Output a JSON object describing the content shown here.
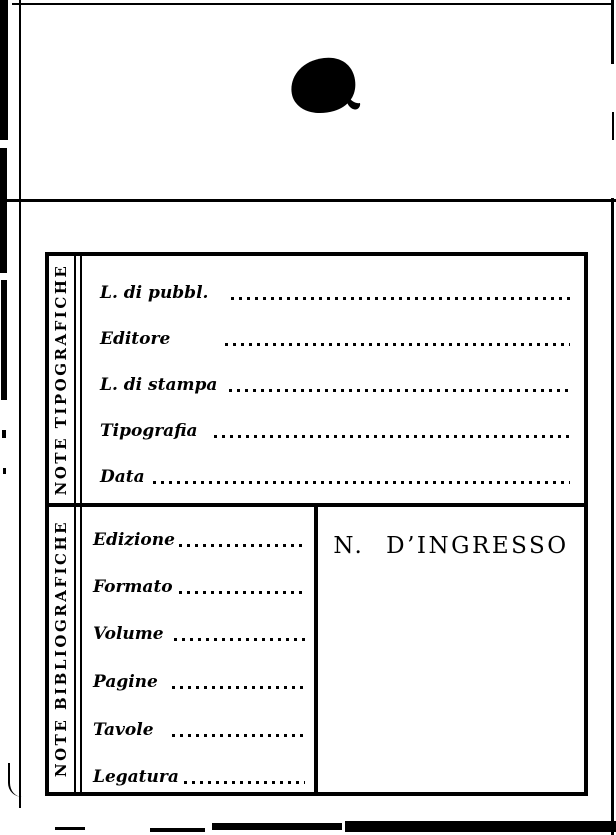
{
  "card": {
    "sections": [
      {
        "caption": "NOTE TIPOGRAFICHE",
        "fields": [
          "L. di pubbl.",
          "Editore",
          "L. di stampa",
          "Tipografia",
          "Data"
        ],
        "values": [
          "",
          "",
          "",
          "",
          ""
        ]
      },
      {
        "caption": "NOTE BIBLIOGRAFICHE",
        "fields": [
          "Edizione",
          "Formato",
          "Volume",
          "Pagine",
          "Tavole",
          "Legatura"
        ],
        "values": [
          "",
          "",
          "",
          "",
          "",
          ""
        ]
      }
    ],
    "ingresso_title": "N. D’INGRESSO"
  },
  "colors": {
    "ink": "#000000",
    "paper": "#ffffff"
  },
  "artifacts": {
    "ink_blot": "ink-blot-stamp"
  }
}
